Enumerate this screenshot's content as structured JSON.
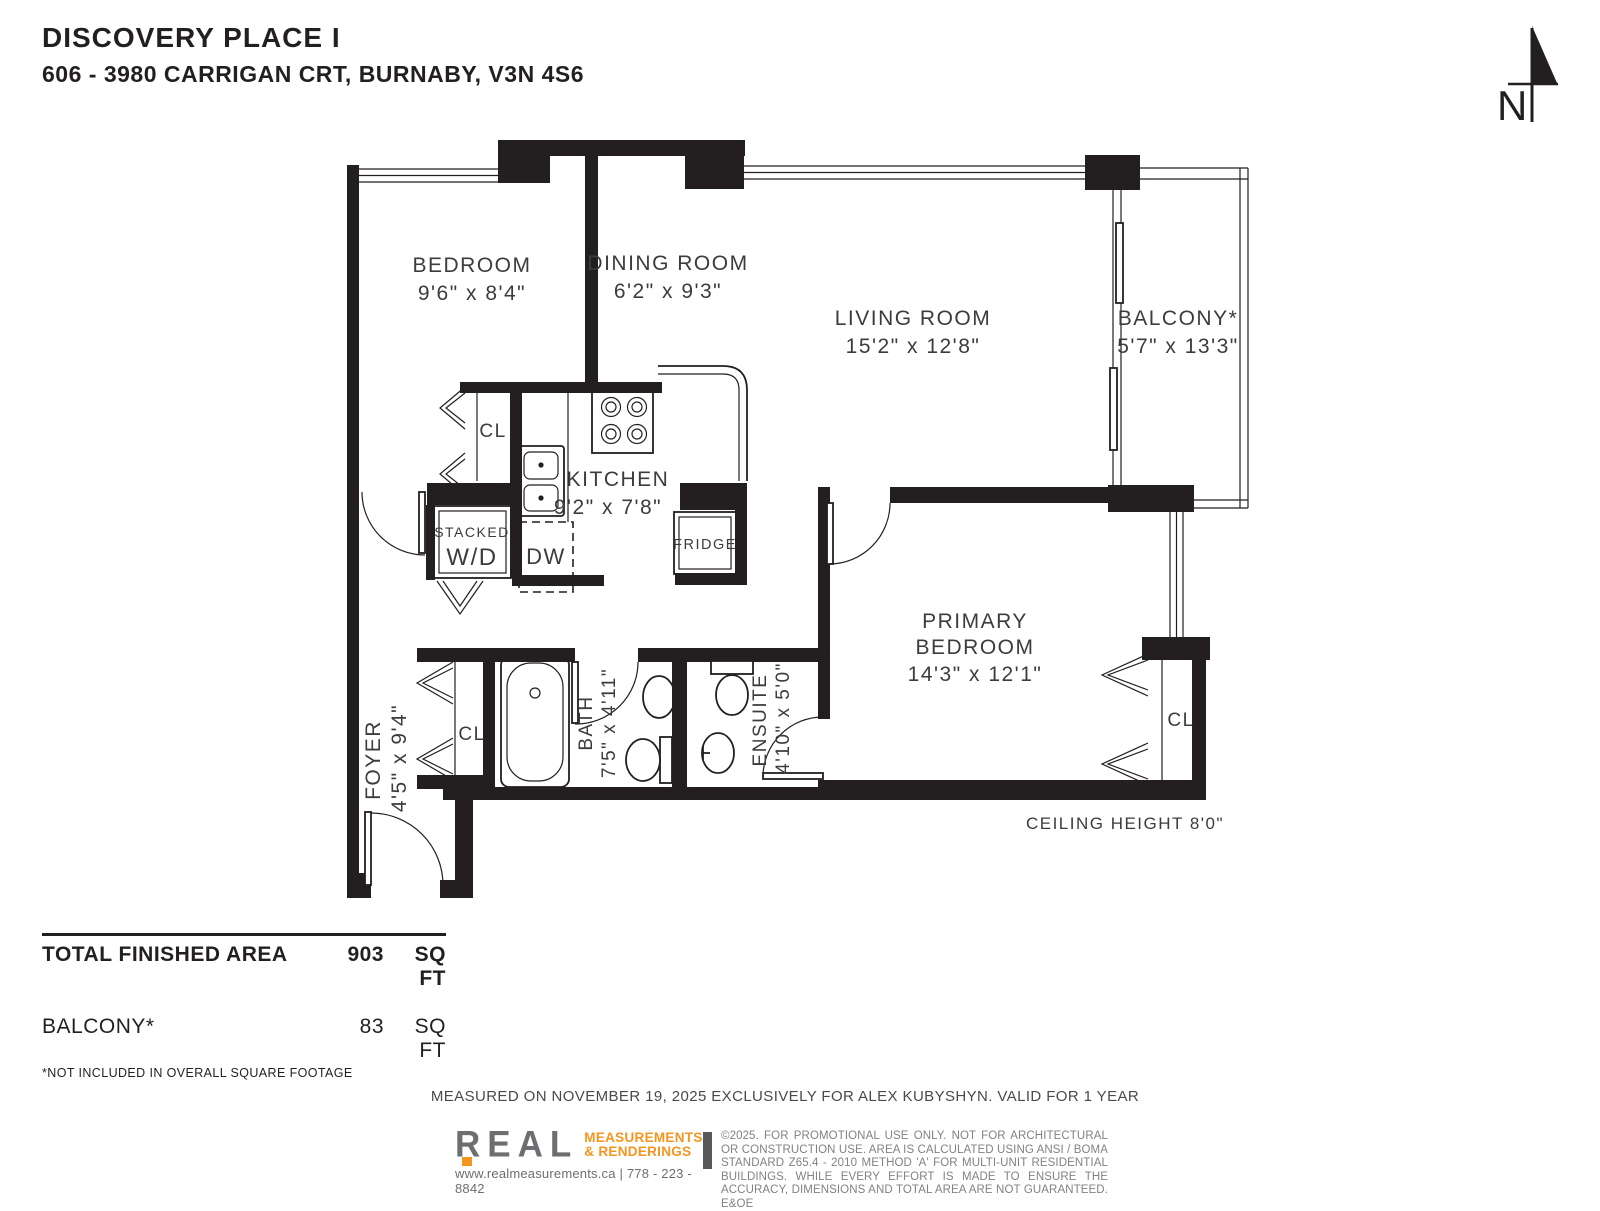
{
  "header": {
    "title": "DISCOVERY PLACE I",
    "address": "606 - 3980 CARRIGAN CRT, BURNABY, V3N 4S6"
  },
  "north": {
    "label": "N"
  },
  "rooms": {
    "bedroom": {
      "name": "BEDROOM",
      "dims": "9'6\" x 8'4\""
    },
    "dining": {
      "name": "DINING ROOM",
      "dims": "6'2\" x 9'3\""
    },
    "living": {
      "name": "LIVING ROOM",
      "dims": "15'2\" x 12'8\""
    },
    "balcony": {
      "name": "BALCONY*",
      "dims": "5'7\" x 13'3\""
    },
    "kitchen": {
      "name": "KITCHEN",
      "dims": "9'2\" x 7'8\""
    },
    "primary": {
      "name_line1": "PRIMARY",
      "name_line2": "BEDROOM",
      "dims": "14'3\" x 12'1\""
    },
    "foyer": {
      "name": "FOYER",
      "dims": "4'5\" x 9'4\""
    },
    "bath": {
      "name": "BATH",
      "dims": "7'5\" x 4'11\""
    },
    "ensuite": {
      "name": "ENSUITE",
      "dims": "4'10\" x 5'0\""
    }
  },
  "fixtures": {
    "closet": "CL",
    "stacked_line1": "STACKED",
    "stacked_line2": "W/D",
    "dishwasher": "DW",
    "fridge": "FRIDGE"
  },
  "notes": {
    "ceiling": "CEILING HEIGHT 8'0\""
  },
  "areas": {
    "total_label": "TOTAL FINISHED AREA",
    "total_value": "903",
    "total_unit": "SQ FT",
    "balcony_label": "BALCONY*",
    "balcony_value": "83",
    "balcony_unit": "SQ FT",
    "footnote": "*NOT INCLUDED IN OVERALL SQUARE FOOTAGE"
  },
  "footer": {
    "measured": "MEASURED ON NOVEMBER 19, 2025 EXCLUSIVELY FOR ALEX KUBYSHYN. VALID FOR 1 YEAR",
    "logo": {
      "name": "REAL",
      "tag_line1": "MEASUREMENTS",
      "tag_line2": "& RENDERINGS",
      "contact": "www.realmeasurements.ca | 778 - 223 - 8842"
    },
    "disclaimer": "©2025. FOR PROMOTIONAL USE ONLY. NOT FOR ARCHITECTURAL OR CONSTRUCTION USE. AREA IS CALCULATED USING ANSI / BOMA STANDARD Z65.4 - 2010 METHOD 'A' FOR MULTI-UNIT RESIDENTIAL BUILDINGS. WHILE EVERY EFFORT IS MADE TO ENSURE THE ACCURACY, DIMENSIONS AND TOTAL AREA ARE NOT GUARANTEED. E&OE"
  },
  "colors": {
    "wall": "#231F20",
    "accent_orange": "#F7941D",
    "logo_gray": "#6D6E71",
    "text_gray": "#808285"
  }
}
